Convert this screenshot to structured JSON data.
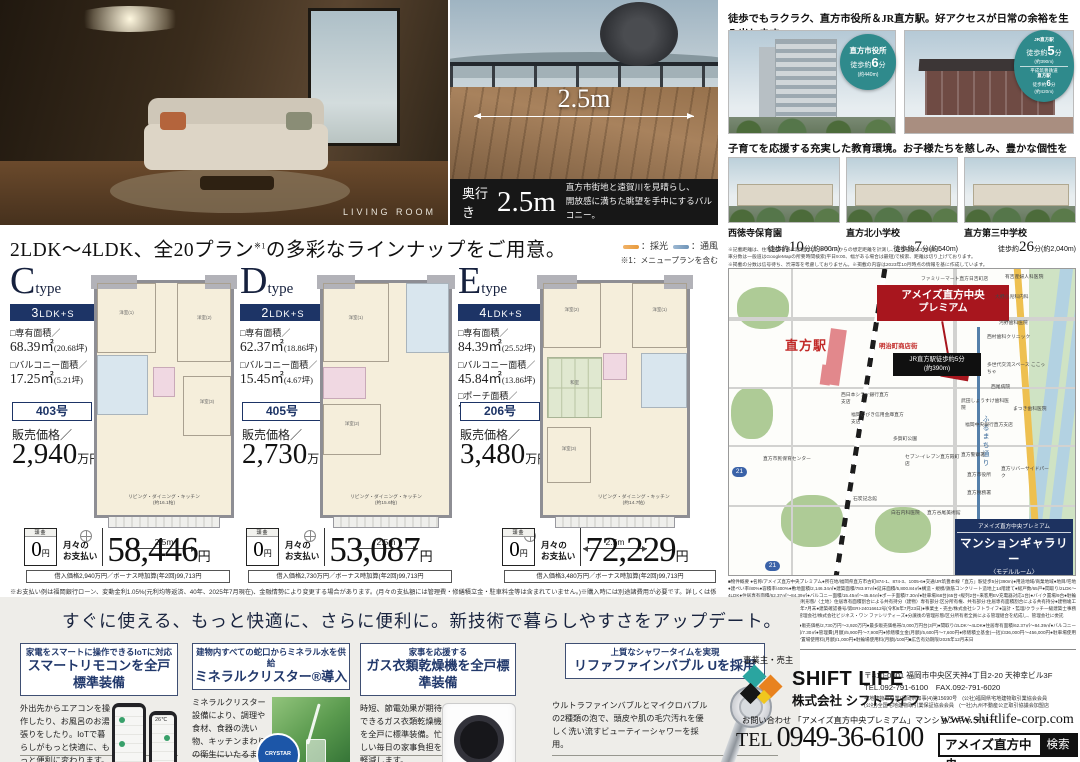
{
  "colors": {
    "navy": "#1d3466",
    "teal": "#2f8a8c",
    "map_red": "#a8161e",
    "gallery_navy": "#1d3260",
    "brand_orange": "#e8821e",
    "brand_teal": "#2aa5a0",
    "brand_yellow": "#f0c61e"
  },
  "hero": {
    "living_caption": "LIVING ROOM",
    "balcony_arrow": "2.5m",
    "balcony_depth_prefix": "奥行き",
    "balcony_depth": "2.5m",
    "balcony_text1": "直方市街地と遠賀川を見晴らし、",
    "balcony_text2": "開放感に満ちた眺望を手中にするバルコニー。"
  },
  "access": {
    "headline_top": "徒歩でもラクラク、直方市役所＆JR直方駅。好アクセスが日常の余裕を生み出します。",
    "cityhall_badge": {
      "name": "直方市役所",
      "pre": "徒歩約",
      "num": "6",
      "post": "分",
      "dist": "(約440m)"
    },
    "station_badge": {
      "jr_name": "JR直方駅",
      "jr_pre": "徒歩約",
      "jr_num": "5",
      "jr_post": "分",
      "jr_dist": "(約390m)",
      "h_line1": "平成筑豊鉄道",
      "h_line2": "直方駅",
      "h_pre": "徒歩約",
      "h_num": "6",
      "h_post": "分",
      "h_dist": "(約420m)"
    },
    "headline_schools": "子育てを応援する充実した教育環境。お子様たちを慈しみ、豊かな個性を伸ばします。",
    "schools": [
      {
        "name": "西徳寺保育園",
        "walk_pre": "徒歩約",
        "walk_num": "10",
        "walk_post": "分",
        "dist": "(約800m)"
      },
      {
        "name": "直方北小学校",
        "walk_pre": "徒歩約",
        "walk_num": "7",
        "walk_post": "分",
        "dist": "(約540m)"
      },
      {
        "name": "直方第三中学校",
        "walk_pre": "徒歩約",
        "walk_num": "26",
        "walk_post": "分",
        "dist": "(約2,040m)"
      }
    ],
    "notes": [
      "※記載距離は、住宅地図を基に建物のエントランスからの想定距離を計測し、徒歩分数は1分=80m、",
      "車分数は一般道はGoogleMapの所要時間検索(平日9:00、幅がある場合は最短)で検索、距離は切り上げております。",
      "※掲載の分数は信号待ち、渋滞等を考慮しておりません。※掲載の内容は2023年10月時点の情報を基に作成しています。"
    ]
  },
  "plans": {
    "headline": "2LDK〜4LDK、全20プラン",
    "headline_sup": "※1",
    "headline_tail": "の多彩なラインナップをご用意。",
    "legend_light": "：採光",
    "legend_wind": "：通風",
    "legend_note": "※1：メニュープランを含む",
    "items": [
      {
        "letter": "C",
        "type_word": "type",
        "num": "3",
        "rest": "LDK+S",
        "spec1_label": "□専有面積／",
        "spec1_value": "68.39㎡",
        "spec1_tsubo": "(20.68坪)",
        "spec2_label": "□バルコニー面積／",
        "spec2_value": "17.25㎡",
        "spec2_tsubo": "(5.21坪)",
        "room_no": "403号",
        "price_label": "販売価格／",
        "price": "2,940",
        "price_unit": "万円",
        "room1": "洋室(1)",
        "room2": "洋室(2)",
        "room3": "洋室(3)",
        "ldk": "リビング・ダイニング・キッチン",
        "ldk_size": "(約16.1帖)",
        "depth": "2.5m",
        "dep_label": "頭金",
        "dep": "0",
        "dep_unit": "円",
        "m1": "月々の",
        "m2": "お支払い",
        "monthly": "58,446",
        "m_unit": "円",
        "loan_note": "借入価格2,940万円／ボーナス時加算(年2回)99,713円"
      },
      {
        "letter": "D",
        "type_word": "type",
        "num": "2",
        "rest": "LDK+S",
        "spec1_label": "□専有面積／",
        "spec1_value": "62.37㎡",
        "spec1_tsubo": "(18.86坪)",
        "spec2_label": "□バルコニー面積／",
        "spec2_value": "15.45㎡",
        "spec2_tsubo": "(4.67坪)",
        "room_no": "405号",
        "price_label": "販売価格／",
        "price": "2,730",
        "price_unit": "万円",
        "room1": "洋室(1)",
        "room2": "洋室(2)",
        "ldk": "リビング・ダイニング・キッチン",
        "ldk_size": "(約15.6帖)",
        "depth": "2.5m",
        "dep_label": "頭金",
        "dep": "0",
        "dep_unit": "円",
        "m1": "月々の",
        "m2": "お支払い",
        "monthly": "53,087",
        "m_unit": "円",
        "loan_note": "借入価格2,730万円／ボーナス時加算(年2回)99,713円"
      },
      {
        "letter": "E",
        "type_word": "type",
        "num": "4",
        "rest": "LDK+S",
        "spec1_label": "□専有面積／",
        "spec1_value": "84.39㎡",
        "spec1_tsubo": "(25.52坪)",
        "spec2_label": "□バルコニー面積／",
        "spec2_value": "45.84㎡",
        "spec2_tsubo": "(13.86坪)",
        "spec3_label": "□ポーチ面積／",
        "spec3_value": "7.30㎡",
        "spec3_tsubo": "(2.20坪)",
        "room_no": "206号",
        "price_label": "販売価格／",
        "price": "3,480",
        "price_unit": "万円",
        "room1": "洋室(1)",
        "room2": "洋室(2)",
        "room3": "洋室(3)",
        "washitsu": "和室",
        "ldk": "リビング・ダイニング・キッチン",
        "ldk_size": "(約14.7帖)",
        "depth": "2.5m",
        "dep_label": "頭金",
        "dep": "0",
        "dep_unit": "円",
        "m1": "月々の",
        "m2": "お支払い",
        "monthly": "72,229",
        "m_unit": "円",
        "loan_note": "借入価格3,480万円／ボーナス時加算(年2回)99,713円"
      }
    ],
    "footnote": "※お支払い例は福岡銀行ローン、変動金利1.05%(元利均等返済、40年、2025年7月現在)、金融情勢により変更する場合があります。(月々の支払額には管理費・修繕積立金・駐車料金等は含まれていません。)※購入時には別途諸費用が必要です。詳しくは係員にお尋ねください。"
  },
  "map": {
    "property_line1": "アメイズ直方中央",
    "property_line2": "プレミアム",
    "station": "直方駅",
    "walk_line1": "JR直方駅徒歩約5分",
    "walk_line2": "(約390m)",
    "shopping_street": "明治町商店街",
    "street_furumachi": "ふるまち通り",
    "route_badge": "21",
    "gallery_header": "アメイズ直方中央プレミアム",
    "gallery_title": "マンションギャラリー",
    "gallery_sub": "〈モデルルーム〉",
    "landmarks": [
      "ファミリーマート直方日吉町店",
      "有吉産婦人科医院",
      "大野小児科内科",
      "河野歯科医院",
      "西村歯科クリニック",
      "多世代交流スペース ここっちゃ",
      "西尾病院",
      "武田しょうすけ歯科医院",
      "まつき歯科医院",
      "福岡中央銀行直方支店",
      "西日本シティ銀行直方支店",
      "福岡ひびき信用金庫直方支店",
      "直方市民保育センター",
      "石炭記念館",
      "セブン-イレブン直方殿町店",
      "直方警察署",
      "直方市役所",
      "直方税務署",
      "直方谷尾美術館",
      "白石内科医院",
      "直方リバーサイドパーク",
      "多賀町公園"
    ]
  },
  "legal": {
    "outline": "■物件概要 ●名称/アメイズ直方中央プレミアム●所在地/福岡県直方市古町874-1、874-3、1005-6●交通/JR筑豊本線「直方」駅徒歩5分(390m)●用途地域/商業地域●地目/宅地●建ぺい率/80%●容積率/400%●敷地面積/2,146.34㎡●建築面積/783.97㎡●延床面積/5,800.84㎡●構造・規模/鉄筋コンクリート造地上14階建て●総戸数/65戸●間取り/2LDK〜4LDK●住居専有面積/62.37㎡〜84.39㎡●バルコニー面積/15.45㎡〜45.84㎡●ポーチ面積/7.30㎡●駐車場/68台(65台+縦列2台+来客用EV充電器対応1台)●バイク置場/9台●駐輪場/スライドラック66台●分譲後の権利形態/〈土地〉住居専有面積割合による共有持分〈建物〉専有部分:区分所有権、共有部分:住居専有面積割合による共有持分●建物竣工予定/令和8年6月末●入居予定/令和8年7月末●建築確認番号/第ERI-24016612号(令和6年7月23日)●事業主・売主/株式会社シフトライフ●設計・監理/クラッチ一級建築士事務所●施工会社/株式会社上田建設社●管理会社/株式会社ビジネス・ワン ファシリティーズ●分譲後の管理形態/区分所有者全員による管理組合を結成し、管理会社に委託",
    "sales": "【第3期販売概要】●販売戸数/15戸●販売価格/2,730万円〜3,920万円●最多販売価格帯/3,000万円台(3戸)●間取り/2LDK〜4LDK●住居専有面積/62.37㎡〜84.39㎡●バルコニー面積/15.45㎡〜45.84㎡●ポーチ面積/7.30㎡●管理費(月額)/5,900円〜7,900円●修繕積立金(月額)/5,600円〜7,600円●修繕積立基金(一括)/336,000円〜456,000円●駐車場使用料(月額)/5,000円〜15,000円●バイク置場使用料(月額)/1,000円●駐輪場使用料(月額)/100円■広告有効期限/2025年12月末日"
  },
  "features": {
    "headline": "すぐに使える、もっと快適に、さらに便利に。新技術で暮らしやすさをアップデート。",
    "items": [
      {
        "t1": "家電をスマートに操作できるIoTに対応",
        "t2": "スマートリモコンを全戸標準装備",
        "body": "外出先からエアコンを操作したり、お風呂のお湯張りをしたり。IoTで暮らしがもっと快適に、もっと便利に変わります。",
        "phone_temp": "26℃"
      },
      {
        "t1": "建物内すべての蛇口からミネラル水を供給",
        "t2": "ミネラルクリスター®導入",
        "body": "ミネラルクリスター設備により、調理や食材、食器の洗い物、キッチンまわりの衛生にいたるまで、さまざまなメリットが期待できます。",
        "badge": "CRYSTAR"
      },
      {
        "t1": "家事を応援する",
        "t2": "ガス衣類乾燥機を全戸標準装備",
        "body": "時短、節電効果が期待できるガス衣類乾燥機を全戸に標準装備。忙しい毎日の家事負担を軽減します。"
      },
      {
        "t1": "上質なシャワータイムを実現",
        "t2": "リファファインバブル Uを採用",
        "body": "ウルトラファインバブルとマイクロバブルの2種類の泡で、頭皮や肌の毛穴汚れを優しく洗い流すビューティーシャワーを採用。"
      }
    ]
  },
  "company": {
    "role": "事業主・売主",
    "logo_text": "SHIFT LIFE",
    "name": "株式会社 シフトライフ",
    "addr1": "〒810-0001 福岡市中央区天神4丁目2-20 天神幸ビル3F",
    "addr2": "TEL.092-791-6100　FAX.092-791-6020",
    "addr3": "宅地建物取引業/福岡県知事(4)第15690号　(公社)福岡県宅地建物取引業協会会員",
    "addr4": "(公社)全国宅地建物取引業保証協会会員　(一社)九州不動産公正取引協議会加盟店",
    "inquiry": "お問い合わせ 「アメイズ直方中央プレミアム」マンションギャラリー",
    "tel_label": "TEL",
    "tel": "0949-36-6100",
    "web": "www.shiftlife-corp.com",
    "search_word": "アメイズ直方中央",
    "search_btn": "検索"
  }
}
